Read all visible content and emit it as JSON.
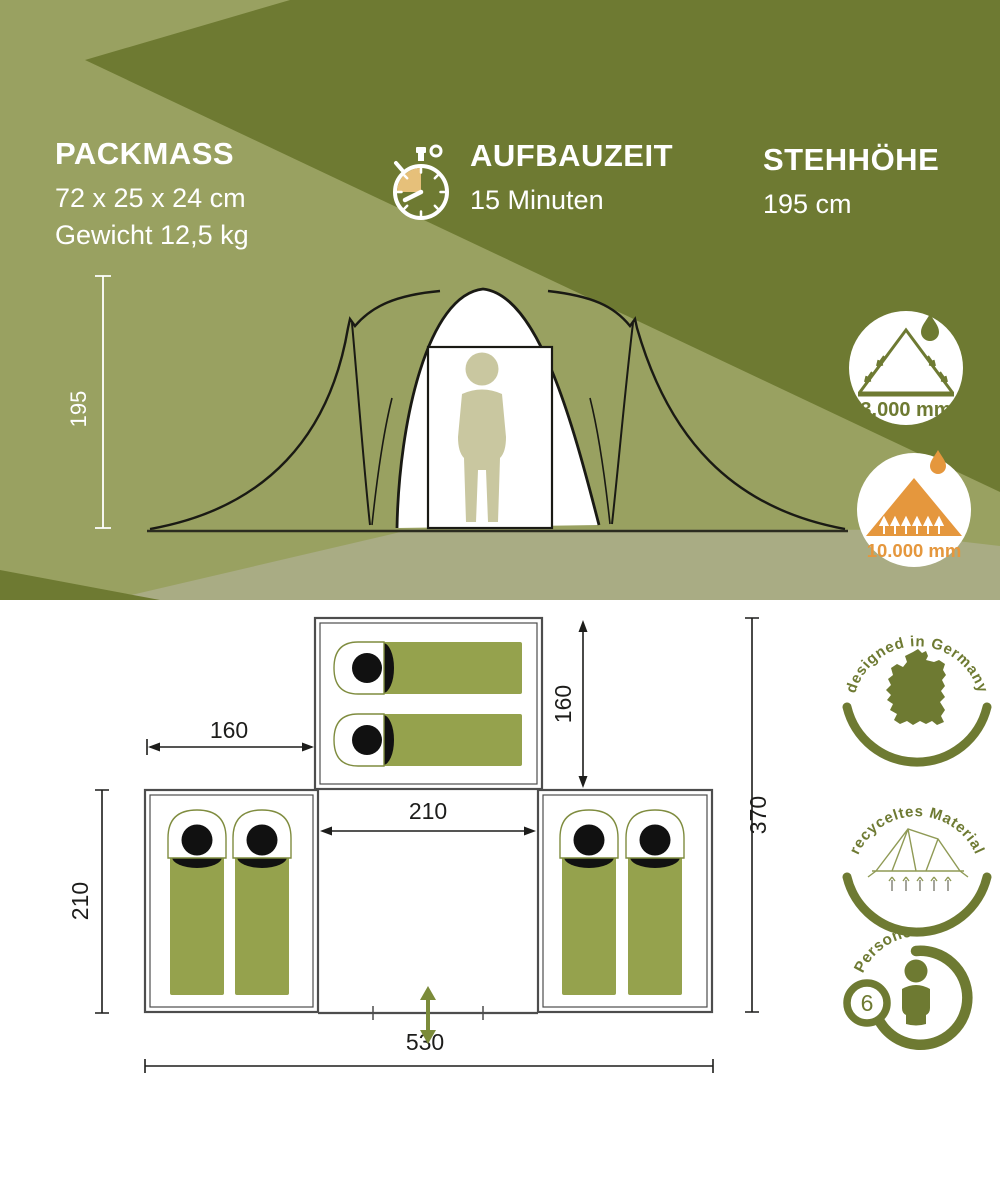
{
  "header": {
    "specs": [
      {
        "id": "packmass",
        "title": "PACKMASS",
        "lines": [
          "72 x 25 x 24 cm",
          "Gewicht 12,5 kg"
        ]
      },
      {
        "id": "aufbauzeit",
        "icon": "stopwatch-icon",
        "title": "AUFBAUZEIT",
        "lines": [
          "15 Minuten"
        ]
      },
      {
        "id": "stehhoehe",
        "title": "STEHHÖHE",
        "lines": [
          "195 cm"
        ]
      }
    ],
    "tent_height_dim": "195",
    "waterproof_badges": [
      {
        "icon": "tent-rain-icon",
        "value": "3.000 mm"
      },
      {
        "icon": "mountain-drop-icon",
        "value": "10.000 mm"
      }
    ]
  },
  "floorplan": {
    "dims": {
      "left_room_width": "160",
      "top_room_depth": "160",
      "center_width": "210",
      "side_room_depth": "210",
      "total_depth": "370",
      "total_width": "530"
    },
    "entrance_icon": "entrance-double-arrow-icon",
    "sleeping_bag_icon": "sleeping-bag-icon"
  },
  "feature_badges": {
    "designed": {
      "icon": "germany-map-icon",
      "label": "designed in Germany"
    },
    "recycled": {
      "icon": "tent-sketch-icon",
      "label": "recyceltes Material"
    },
    "persons": {
      "icon": "person-icon",
      "label": "Personen",
      "count": "6"
    }
  },
  "colors": {
    "olive_dark": "#6e7a32",
    "olive_light": "#99a161",
    "ground_band": "#a9ac84",
    "accent_orange": "#e5973d",
    "plan_green": "#95a24d",
    "stopwatch_wedge": "#e6c07a",
    "person_beige": "#c9c7a0",
    "wall_gray": "#4d4d4d",
    "dim_black": "#1d1d1b"
  }
}
